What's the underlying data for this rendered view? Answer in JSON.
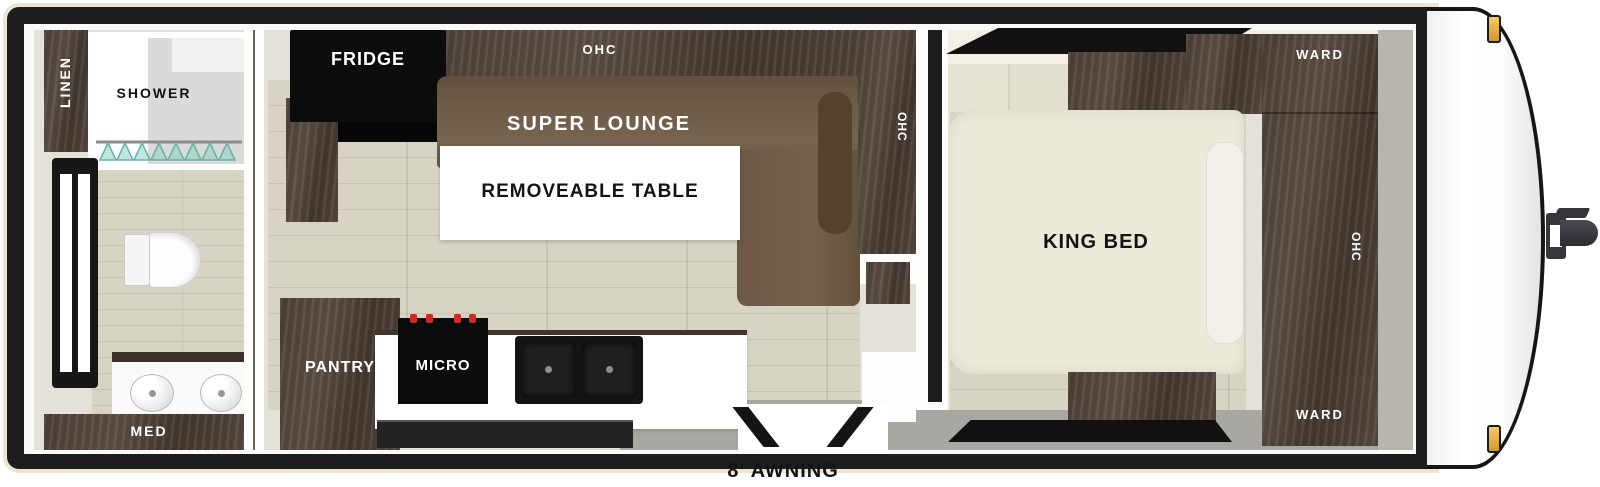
{
  "labels": {
    "linen": "LINEN",
    "shower": "SHOWER",
    "med": "MED",
    "fridge": "FRIDGE",
    "ohc_top": "OHC",
    "super_lounge": "SUPER LOUNGE",
    "removeable_table": "REMOVEABLE TABLE",
    "ohc_side": "OHC",
    "pantry": "PANTRY",
    "micro": "MICRO",
    "king_bed": "KING BED",
    "ward_top": "WARD",
    "ohc_ward": "OHC",
    "ward_bottom": "WARD",
    "awning": "8’ AWNING"
  },
  "fixtures": {
    "bathroom": [
      "linen-cabinet",
      "shower-stall",
      "clothes-rod-with-hangers",
      "side-window",
      "toilet",
      "vanity-with-two-sinks",
      "med-cabinet"
    ],
    "living": [
      "refrigerator",
      "overhead-cabinet-strip",
      "super-lounge-sofa",
      "removable-table",
      "side-overhead-cabinet",
      "pantry",
      "microwave-range",
      "double-bowl-sink",
      "kitchen-counter",
      "entry-door"
    ],
    "bedroom": [
      "front-window",
      "headboard",
      "overhead-cabinet",
      "king-bed",
      "pillow",
      "nightstand",
      "rear-window",
      "wardrobe-column"
    ],
    "exterior": [
      "front-cap",
      "marker-light-top",
      "marker-light-bottom",
      "hitch-coupler",
      "awning-label"
    ]
  },
  "colors": {
    "frame": "#1d1d1d",
    "skin": "#ece5d2",
    "wall": "#e4e1d8",
    "wall_gray": "#b8b5ad",
    "floor_wood": "#d8d4c3",
    "floor_line": "#c7c3b1",
    "walkway_gray": "#a9a7a1",
    "cabinet_dark": "#4e4138",
    "lounge_brown": "#6e5b47",
    "lounge_dark": "#55412e",
    "bed_cream": "#ece9d8",
    "counter_white": "#ffffff",
    "appliance_black": "#0c0c0c",
    "knob_red": "#cf2b20",
    "hanger_teal": "#62b4a6",
    "marker_amber": "#eeb04b",
    "label_white": "#ffffff",
    "label_black": "#131313"
  }
}
